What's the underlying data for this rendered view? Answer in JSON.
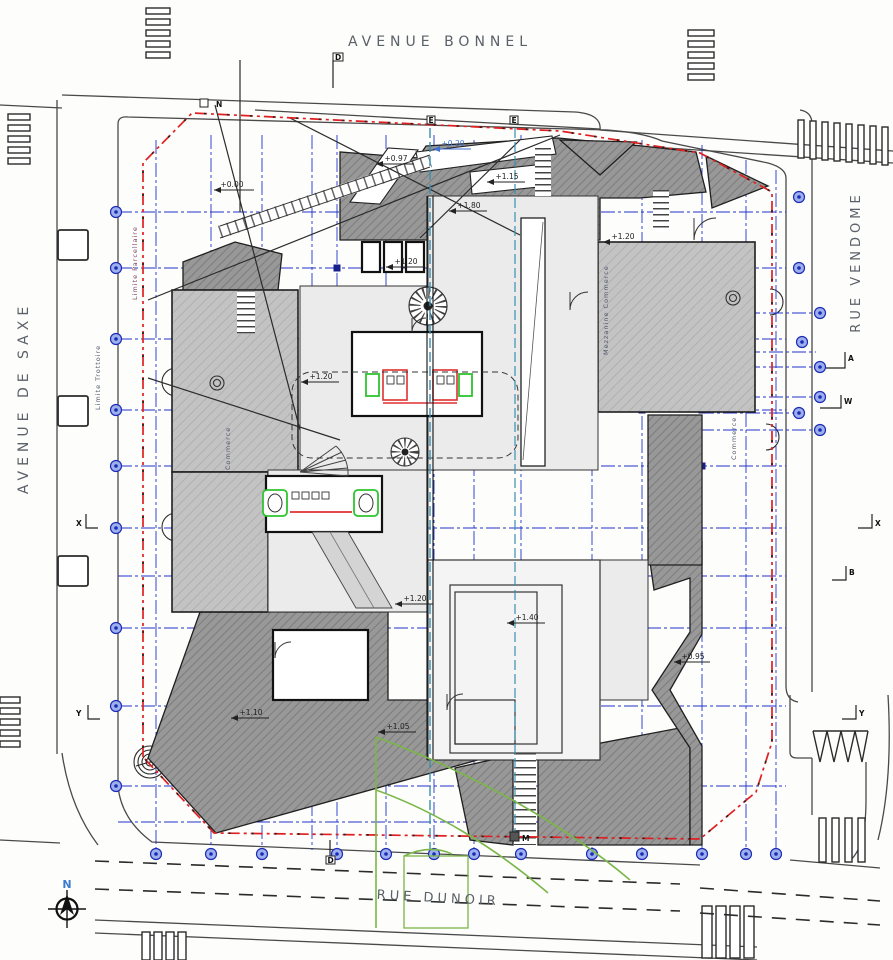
{
  "streets": {
    "top": "AVENUE BONNEL",
    "left": "AVENUE DE SAXE",
    "right": "RUE VENDOME",
    "bottom": "RUE DUNOIR"
  },
  "north": {
    "label": "N"
  },
  "zones": {
    "limite_parcellaire": "Limite Parcellaire",
    "limite_trottoire": "Limite Trottoire",
    "commerce_left": "Commerce",
    "mezzanine_commerce": "Mezzanine Commerce",
    "commerce_right": "Commerce"
  },
  "levels": [
    {
      "value": "+0.00"
    },
    {
      "value": "+0.97"
    },
    {
      "value": "+0.20"
    },
    {
      "value": "+1.15"
    },
    {
      "value": "+1.80"
    },
    {
      "value": "+1.20"
    },
    {
      "value": "+1.20"
    },
    {
      "value": "+1.20"
    },
    {
      "value": "+1.20"
    },
    {
      "value": "+1.40"
    },
    {
      "value": "+1.05"
    },
    {
      "value": "+1.10"
    },
    {
      "value": "+0.95"
    }
  ],
  "markers": [
    {
      "letter": "N"
    },
    {
      "letter": "D"
    },
    {
      "letter": "E"
    },
    {
      "letter": "E"
    },
    {
      "letter": "A"
    },
    {
      "letter": "W"
    },
    {
      "letter": "X"
    },
    {
      "letter": "X"
    },
    {
      "letter": "B"
    },
    {
      "letter": "Y"
    },
    {
      "letter": "Y"
    },
    {
      "letter": "M"
    },
    {
      "letter": "D"
    }
  ],
  "colors": {
    "grid_blue": "#2233cc",
    "property_red": "#e02020",
    "sweep_green": "#7ab648",
    "fixture_green": "#2ec42e",
    "elevator_red": "#e03030",
    "section_teal": "#3a8fb0",
    "north_blue": "#3a7bd0",
    "dark_hatch": "#8f8f8f",
    "light_plate": "#ebebeb"
  }
}
